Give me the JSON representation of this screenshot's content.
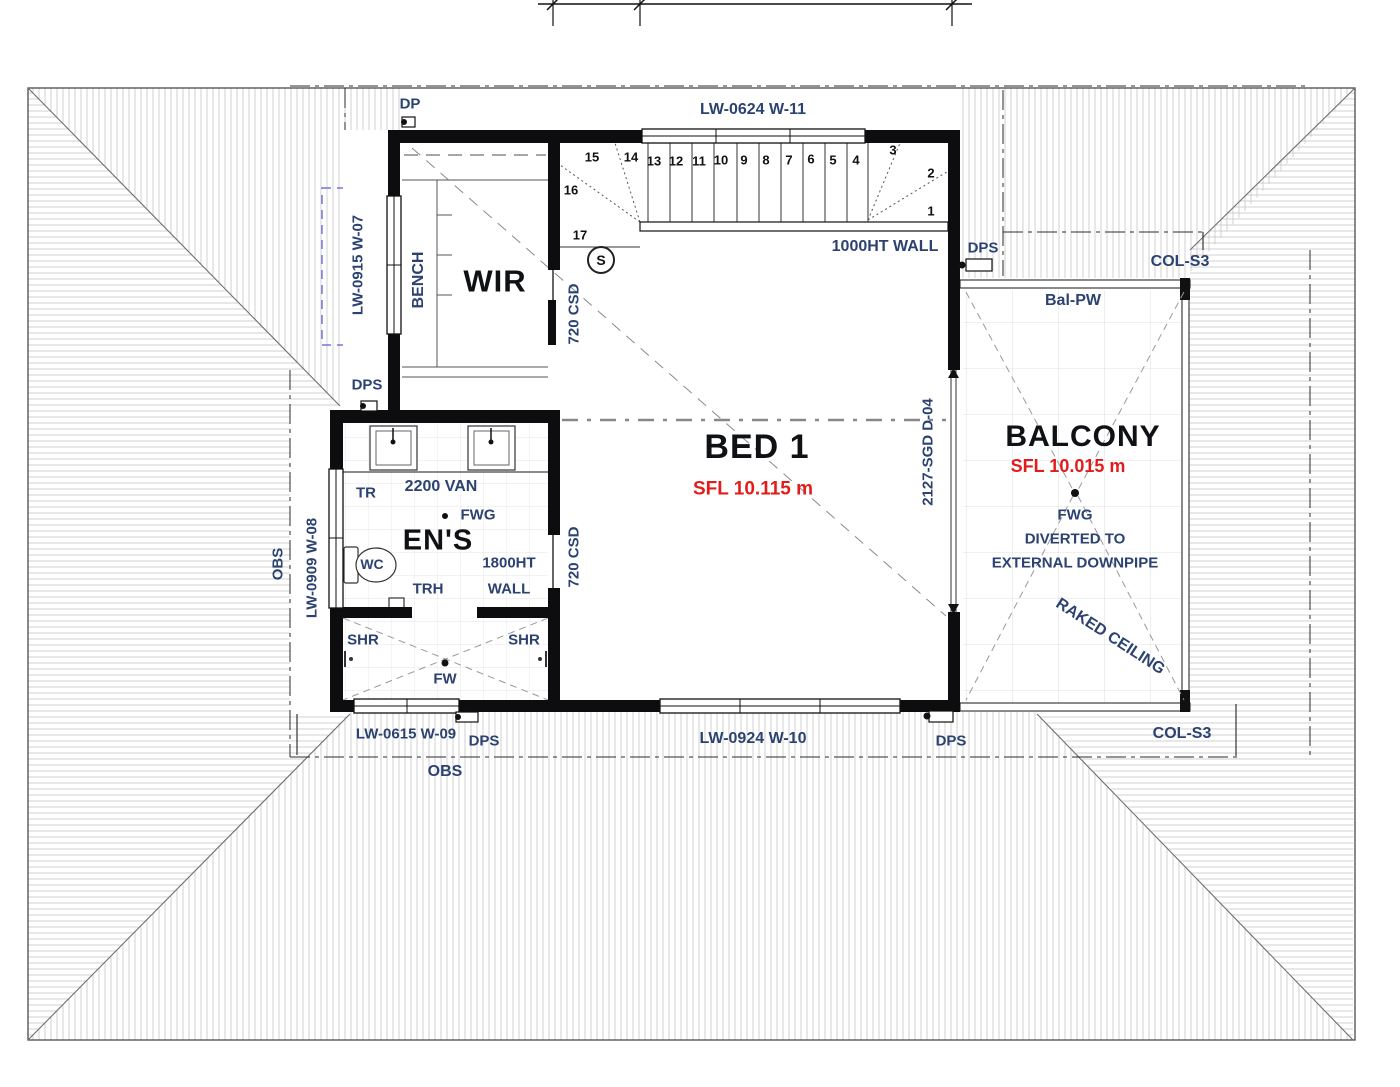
{
  "drawing": {
    "rooms": {
      "wir": "WIR",
      "bed1": "BED 1",
      "bed1_sfl": "SFL 10.115 m",
      "ens": "EN'S",
      "balcony": "BALCONY",
      "balcony_sfl": "SFL 10.015 m"
    },
    "windows": {
      "w07": "LW-0915 W-07",
      "w08": "LW-0909 W-08",
      "w09": "LW-0615 W-09",
      "w10": "LW-0924 W-10",
      "w11": "LW-0624 W-11"
    },
    "doors": {
      "csd": "720 CSD",
      "sgd": "2127-SGD D-04"
    },
    "annotations": {
      "dp": "DP",
      "dps": "DPS",
      "obs": "OBS",
      "bench": "BENCH",
      "van": "2200 VAN",
      "tr": "TR",
      "wc": "WC",
      "trh": "TRH",
      "shr": "SHR",
      "fw": "FW",
      "fwg": "FWG",
      "wall_1800_line1": "1800HT",
      "wall_1800_line2": "WALL",
      "wall_1000": "1000HT WALL",
      "bal_pw": "Bal-PW",
      "col_s3": "COL-S3",
      "raked_ceiling": "RAKED CEILING",
      "fwg_note_line1": "FWG",
      "fwg_note_line2": "DIVERTED TO",
      "fwg_note_line3": "EXTERNAL DOWNPIPE",
      "smoke_detector": "S"
    },
    "stairs": [
      "1",
      "2",
      "3",
      "4",
      "5",
      "6",
      "7",
      "8",
      "9",
      "10",
      "11",
      "12",
      "13",
      "14",
      "15",
      "16",
      "17"
    ],
    "colors": {
      "label_blue": "#2c4270",
      "text_dark": "#0f1115",
      "sfl_red": "#e31b1b",
      "wall_black": "#0d0d0f",
      "hatch_grey": "#c6c6c6"
    }
  }
}
